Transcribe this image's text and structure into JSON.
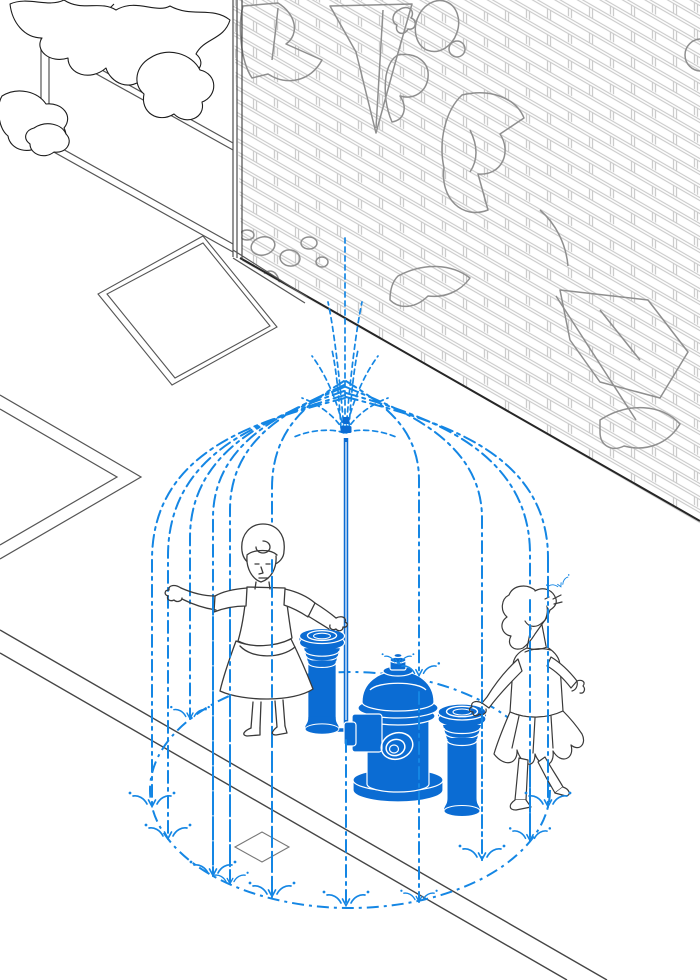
{
  "scene": {
    "title": "Isometric street illustration: fire hydrant converted into a sprinkler dome with two figures playing in the water",
    "style": "technical line drawing, no visible text"
  },
  "colors": {
    "water_blue": "#1486e4",
    "solid_blue": "#0b6cd3",
    "figure_line": "#3a3a3a",
    "street_line": "#4a4a4a",
    "wall_base": "#262626",
    "brick_mortar": "#c9c9c9",
    "graffiti_gray": "#8f8f8f",
    "background": "#ffffff"
  },
  "objects": {
    "brick_wall": "isometric brick wall covered with graffiti outlines",
    "graffiti": "abstract wildstyle graffiti outlines",
    "tree": "tree canopy line drawing",
    "fence": "fence rails and post at street corner",
    "pavement_slab": "double-outlined pavement slab",
    "sidewalk_joint": "sidewalk expansion joint chevron",
    "curb": "street curb double line",
    "paver_diamond": "diamond paver tile",
    "ground_ring": "dash-dot ellipse where the water lands",
    "water_dome": "dashed water jets arcing into a dome canopy",
    "spray_fan": "jet fan at the top of the riser",
    "riser_pipe": "vertical riser pipe feeding the spray head",
    "fire_hydrant": "blue fire hydrant with side and front nozzles",
    "bollard_left": "blue water bollard",
    "bollard_right": "blue water bollard",
    "woman": "woman with arms outstretched standing under the spray",
    "girl": "girl catching water in her mouth while touching a bollard",
    "splash": "water splash glyph"
  }
}
